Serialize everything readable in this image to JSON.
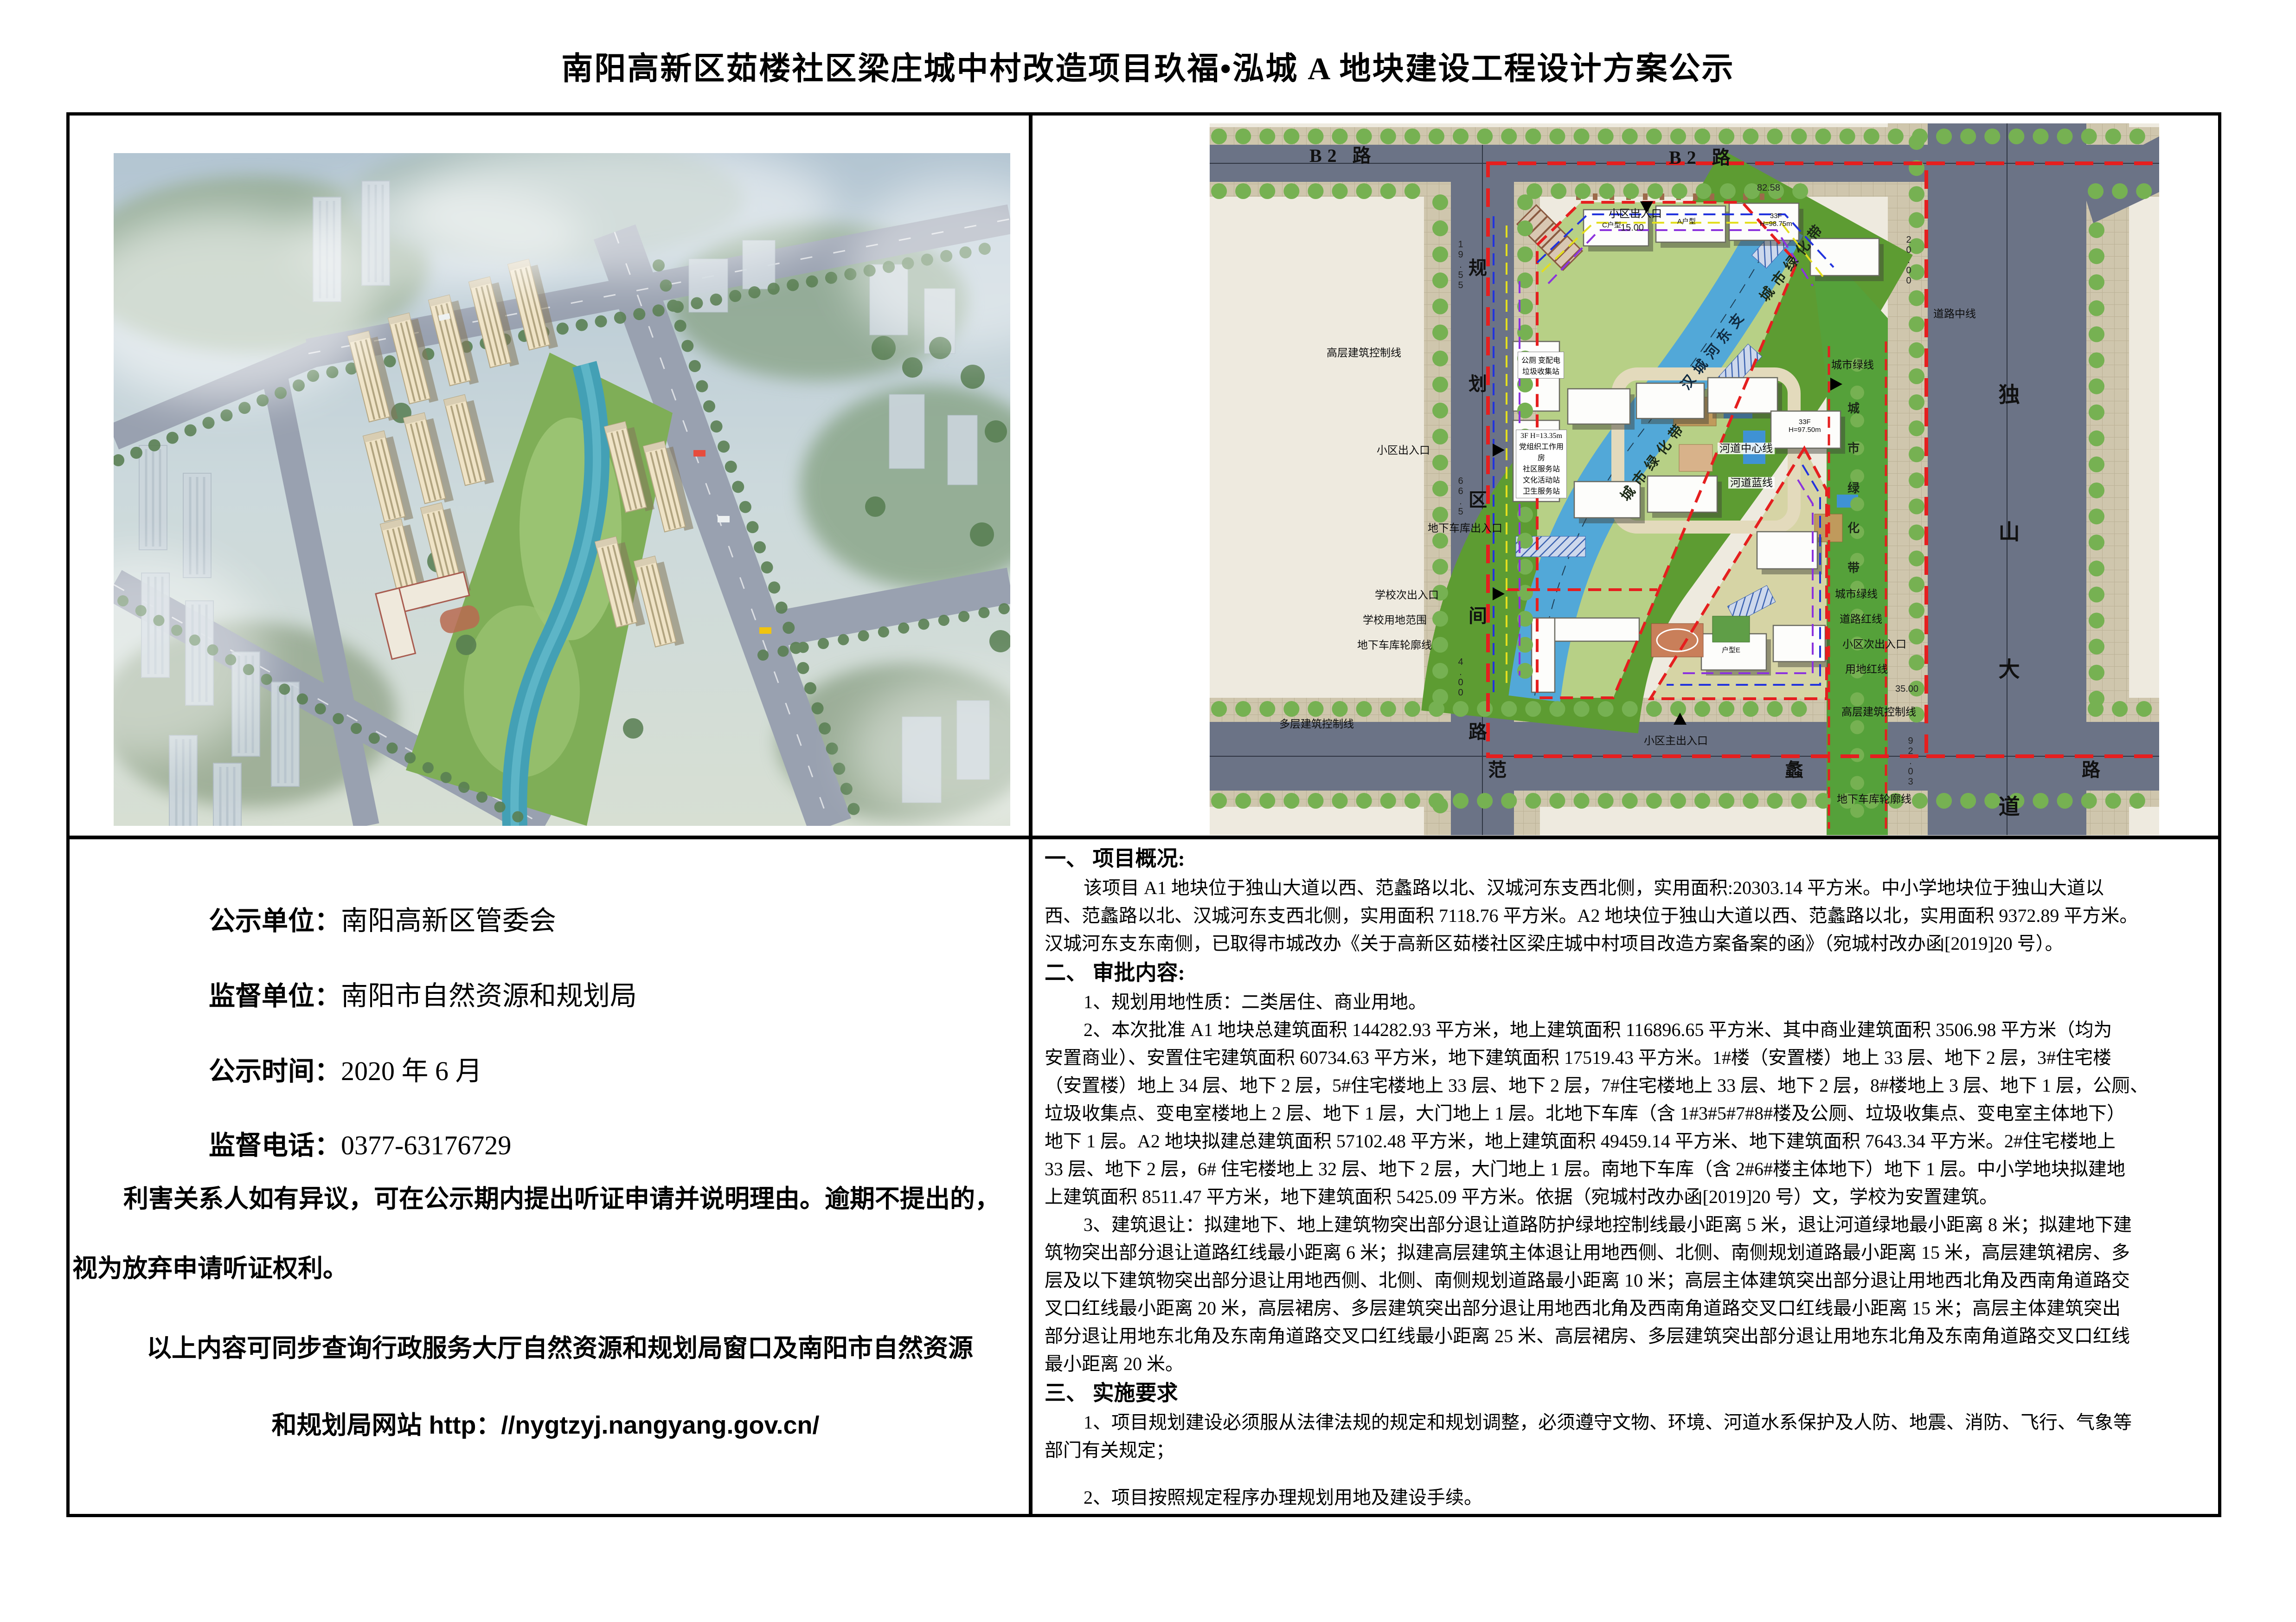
{
  "page": {
    "title": "南阳高新区茹楼社区梁庄城中村改造项目玖福•泓城 A 地块建设工程设计方案公示"
  },
  "notice": {
    "rows": [
      {
        "label": "公示单位：",
        "value": "南阳高新区管委会"
      },
      {
        "label": "监督单位：",
        "value": "南阳市自然资源和规划局"
      },
      {
        "label": "公示时间：",
        "value": "2020 年 6 月"
      },
      {
        "label": "监督电话：",
        "value": "0377-63176729"
      }
    ],
    "para1": "利害关系人如有异议，可在公示期内提出听证申请并说明理由。逾期不提出的，视为放弃申请听证权利。",
    "para2": "以上内容可同步查询行政服务大厅自然资源和规划局窗口及南阳市自然资源",
    "para3": "和规划局网站 http：//nygtzyj.nangyang.gov.cn/"
  },
  "overview": {
    "lines": [
      "一、 项目概况:",
      "该项目 A1 地块位于独山大道以西、范蠡路以北、汉城河东支西北侧，实用面积:20303.14 平方米。中小学地块位于独山大道以",
      "西、范蠡路以北、汉城河东支西北侧，实用面积 7118.76 平方米。A2 地块位于独山大道以西、范蠡路以北，实用面积 9372.89 平方米。",
      "汉城河东支东南侧，已取得市城改办《关于高新区茹楼社区梁庄城中村项目改造方案备案的函》（宛城村改办函[2019]20 号）。",
      "二、 审批内容:",
      "1、规划用地性质：二类居住、商业用地。",
      "2、本次批准 A1 地块总建筑面积 144282.93 平方米，地上建筑面积 116896.65 平方米、其中商业建筑面积 3506.98 平方米（均为",
      "安置商业）、安置住宅建筑面积 60734.63 平方米，地下建筑面积 17519.43 平方米。1#楼（安置楼）地上 33 层、地下 2 层，3#住宅楼",
      "（安置楼）地上 34 层、地下 2 层，5#住宅楼地上 33 层、地下 2 层，7#住宅楼地上 33 层、地下 2 层，8#楼地上 3 层、地下 1 层，公厕、",
      "垃圾收集点、变电室楼地上 2 层、地下 1 层，大门地上 1 层。北地下车库（含 1#3#5#7#8#楼及公厕、垃圾收集点、变电室主体地下）",
      "地下 1 层。A2 地块拟建总建筑面积 57102.48 平方米，地上建筑面积 49459.14 平方米、地下建筑面积 7643.34 平方米。2#住宅楼地上",
      "33 层、地下 2 层，6# 住宅楼地上 32 层、地下 2 层，大门地上 1 层。南地下车库（含 2#6#楼主体地下）地下 1 层。中小学地块拟建地",
      "上建筑面积 8511.47 平方米，地下建筑面积 5425.09 平方米。依据（宛城村改办函[2019]20 号）文，学校为安置建筑。",
      "3、建筑退让：拟建地下、地上建筑物突出部分退让道路防护绿地控制线最小距离 5 米，退让河道绿地最小距离 8 米；拟建地下建",
      "筑物突出部分退让道路红线最小距离 6 米；拟建高层建筑主体退让用地西侧、北侧、南侧规划道路最小距离 15 米，高层建筑裙房、多",
      "层及以下建筑物突出部分退让用地西侧、北侧、南侧规划道路最小距离 10 米；高层主体建筑突出部分退让用地西北角及西南角道路交",
      "叉口红线最小距离 20 米，高层裙房、多层建筑突出部分退让用地西北角及西南角道路交叉口红线最小距离 15 米；高层主体建筑突出",
      "部分退让用地东北角及东南角道路交叉口红线最小距离 25 米、高层裙房、多层建筑突出部分退让用地东北角及东南角道路交叉口红线",
      "最小距离 20 米。",
      "三、 实施要求",
      "1、项目规划建设必须服从法律法规的规定和规划调整，必须遵守文物、环境、河道水系保护及人防、地震、消防、飞行、气象等",
      "部门有关规定；",
      "2、项目按照规定程序办理规划用地及建设手续。"
    ]
  },
  "plan": {
    "b2_left": "B2 路",
    "b2_right": "B2 路",
    "left_road": "规划区间路",
    "dushan": "独山大道",
    "fanli": "范蠡路",
    "river": "汉城河东支",
    "band_upper": "城市绿化带",
    "band_lower": "城市绿化带",
    "strip_right": "城市绿化带",
    "lbl_daolu_zhongxian": "道路中线",
    "lbl_chengshi_lvxian1": "城市绿线",
    "lbl_hedao_zhongxin": "河道中心线",
    "lbl_hedao_lanxian": "河道蓝线",
    "lbl_chengshi_lvxian2": "城市绿线",
    "lbl_daolu_hongxian": "道路红线",
    "lbl_xiaoqu_ci": "小区次出入口",
    "lbl_yongdi_hongxian": "用地红线",
    "lbl_entry_top": "小区出入口",
    "lbl_entry_left": "小区出入口",
    "lbl_entry_main": "小区主出入口",
    "lbl_school_entry": "学校次出入口",
    "lbl_school_area": "学校用地范围",
    "lbl_garage_outline": "地下车库轮廓线",
    "lbl_garage_outline_r": "地下车库轮廓线",
    "lbl_garage_entry": "地下车库出入口",
    "lbl_gaoceng": "高层建筑控制线",
    "lbl_gaoceng_r": "高层建筑控制线",
    "lbl_duoceng": "多层建筑控制线",
    "box1": "公厕 变配电\n垃圾收集站",
    "box2": "3F H=13.35m\n党组织工作用房\n社区服务站\n文化活动站\n卫生服务站",
    "bldg1": "C户型",
    "bldg2": "A户型",
    "bldg3": "33F\nH=98.75m",
    "bldg4": "33F\nH=97.50m",
    "bldg5": "户型E",
    "dim1": "82.58",
    "dim2": "15.00",
    "dim3": "20.00",
    "dim4": "35.00",
    "dim5": "19.55",
    "dim6": "66.5",
    "dim7": "92.03",
    "dim8": "4.00"
  },
  "colors": {
    "boundary_red": "#e51f1f",
    "road_gray": "#6b7386",
    "green_belt": "#5d9c32",
    "river_blue": "#52a8d8",
    "plan_cream": "#eeeadf"
  }
}
